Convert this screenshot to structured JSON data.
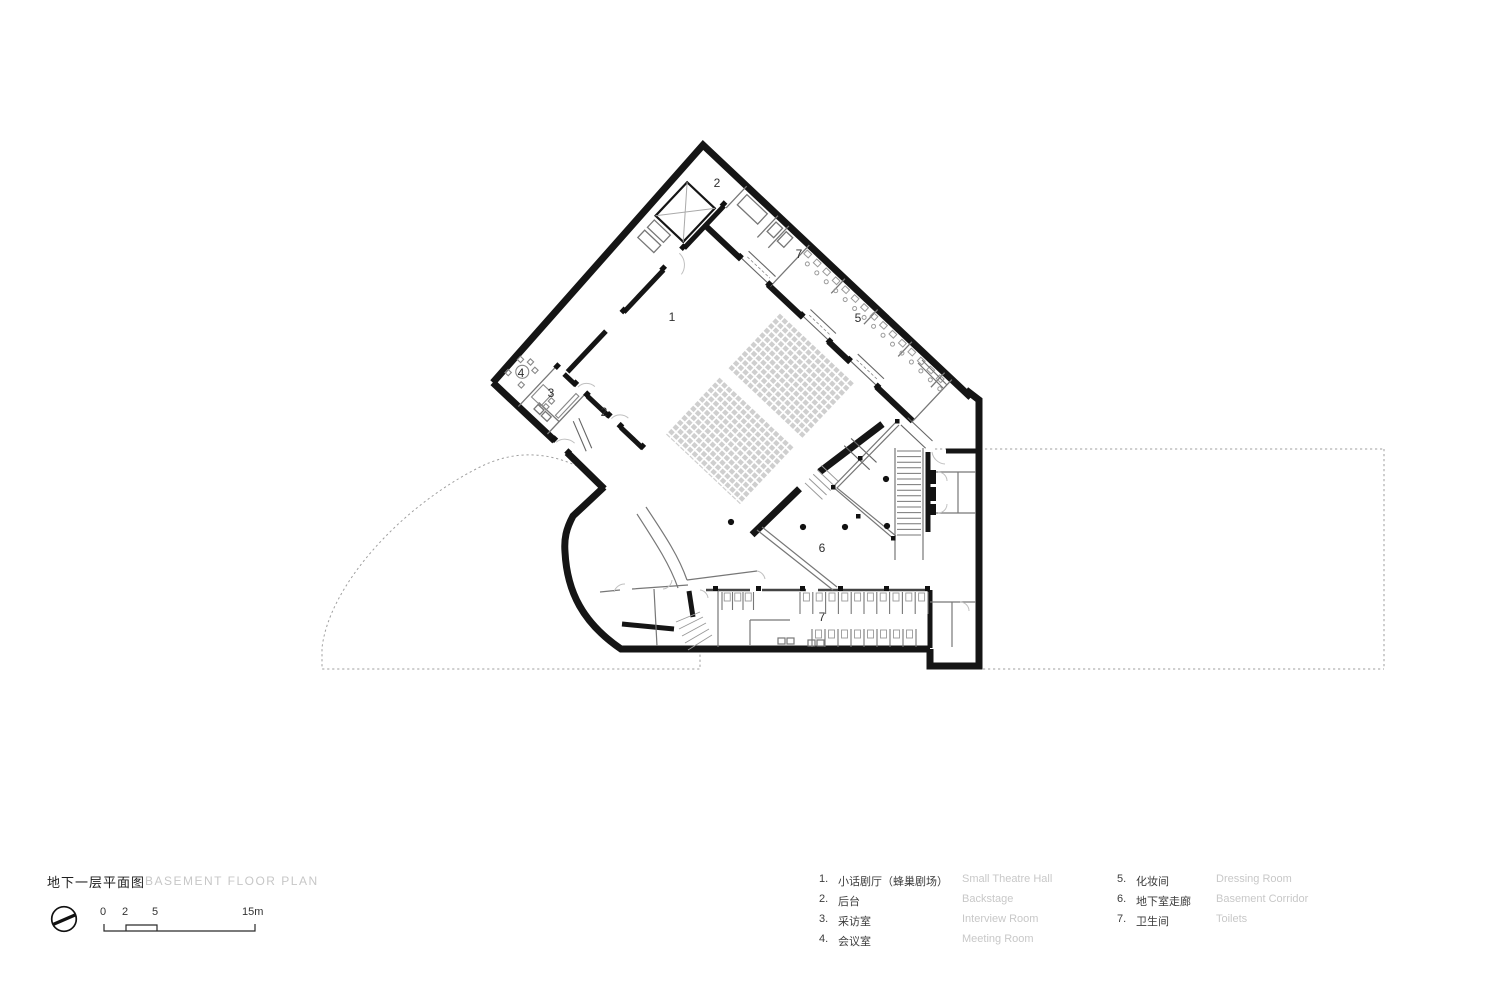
{
  "title": {
    "zh": "地下一层平面图",
    "en": "BASEMENT FLOOR PLAN"
  },
  "scale_bar": {
    "labels": [
      "0",
      "2",
      "5",
      "15m"
    ]
  },
  "legend": {
    "col1": [
      {
        "num": "1.",
        "zh": "小话剧厅（蜂巢剧场）",
        "en": "Small Theatre Hall"
      },
      {
        "num": "2.",
        "zh": "后台",
        "en": "Backstage"
      },
      {
        "num": "3.",
        "zh": "采访室",
        "en": "Interview Room"
      },
      {
        "num": "4.",
        "zh": "会议室",
        "en": "Meeting Room"
      }
    ],
    "col2": [
      {
        "num": "5.",
        "zh": "化妆间",
        "en": "Dressing Room"
      },
      {
        "num": "6.",
        "zh": "地下室走廊",
        "en": "Basement Corridor"
      },
      {
        "num": "7.",
        "zh": "卫生间",
        "en": "Toilets"
      }
    ]
  },
  "plan": {
    "room_labels": [
      {
        "name": "small-theatre-hall",
        "text": "1",
        "x": 672,
        "y": 317
      },
      {
        "name": "backstage-top",
        "text": "2",
        "x": 717,
        "y": 183
      },
      {
        "name": "band-toilet",
        "text": "7",
        "x": 799,
        "y": 254
      },
      {
        "name": "dressing-rooms",
        "text": "5",
        "x": 858,
        "y": 318
      },
      {
        "name": "meeting-room",
        "text": "4",
        "x": 521,
        "y": 373
      },
      {
        "name": "interview-room",
        "text": "3",
        "x": 551,
        "y": 393
      },
      {
        "name": "backstage-left",
        "text": "2",
        "x": 604,
        "y": 412
      },
      {
        "name": "basement-corridor",
        "text": "6",
        "x": 822,
        "y": 548
      },
      {
        "name": "toilets",
        "text": "7",
        "x": 822,
        "y": 617
      }
    ],
    "seats": {
      "rows": 16,
      "x0": 174,
      "step": 6.45,
      "y_front": 70,
      "aisle_start": 146,
      "aisle_end": 158,
      "y_back": 236
    },
    "ramps": [
      [
        106,
        143
      ],
      [
        191,
        226
      ],
      [
        256,
        292
      ]
    ],
    "stools": {
      "x0": 148,
      "x1": 340,
      "step": 13
    },
    "stair": {
      "x1": 897,
      "x2": 921,
      "y0": 451,
      "step": 5.6,
      "n": 16
    },
    "columns": [
      [
        731,
        522
      ],
      [
        803,
        527
      ],
      [
        845,
        527
      ],
      [
        887,
        526
      ],
      [
        886,
        479
      ]
    ],
    "prow_dots": [
      [
        897,
        421
      ],
      [
        860,
        458
      ],
      [
        833,
        487
      ],
      [
        858,
        516
      ],
      [
        893,
        538
      ]
    ],
    "stalls": [
      {
        "x0": 800,
        "n": 10,
        "step": 12.8,
        "y": 592,
        "h": 22
      },
      {
        "x0": 812,
        "n": 8,
        "step": 13.0,
        "y": 629,
        "h": 18
      },
      {
        "x0": 722,
        "n": 3,
        "step": 10.5,
        "y": 592,
        "h": 18
      }
    ],
    "jambs_local": [
      [
        101,
        53
      ],
      [
        141,
        53
      ],
      [
        186,
        53
      ],
      [
        224,
        53
      ],
      [
        251,
        53
      ],
      [
        290,
        53
      ],
      [
        53,
        26
      ],
      [
        53,
        85
      ],
      [
        53,
        114
      ],
      [
        53,
        172
      ],
      [
        68,
        258
      ],
      [
        84,
        258
      ],
      [
        114,
        258
      ],
      [
        130,
        258
      ],
      [
        160,
        258
      ],
      [
        43,
        258
      ],
      [
        91,
        313
      ],
      [
        110,
        313
      ]
    ],
    "jambs_global": [
      [
        713,
        586
      ],
      [
        756,
        586
      ],
      [
        800,
        586
      ],
      [
        838,
        586
      ],
      [
        884,
        586
      ],
      [
        925,
        586
      ]
    ]
  },
  "colors": {
    "wall": "#151515",
    "thin": "#777777",
    "light": "#bdbdbd",
    "seat": "#cfcfcf",
    "dashed": "#9f9f9f",
    "muted_text": "#c8c8c8",
    "text": "#3c3c3c"
  }
}
